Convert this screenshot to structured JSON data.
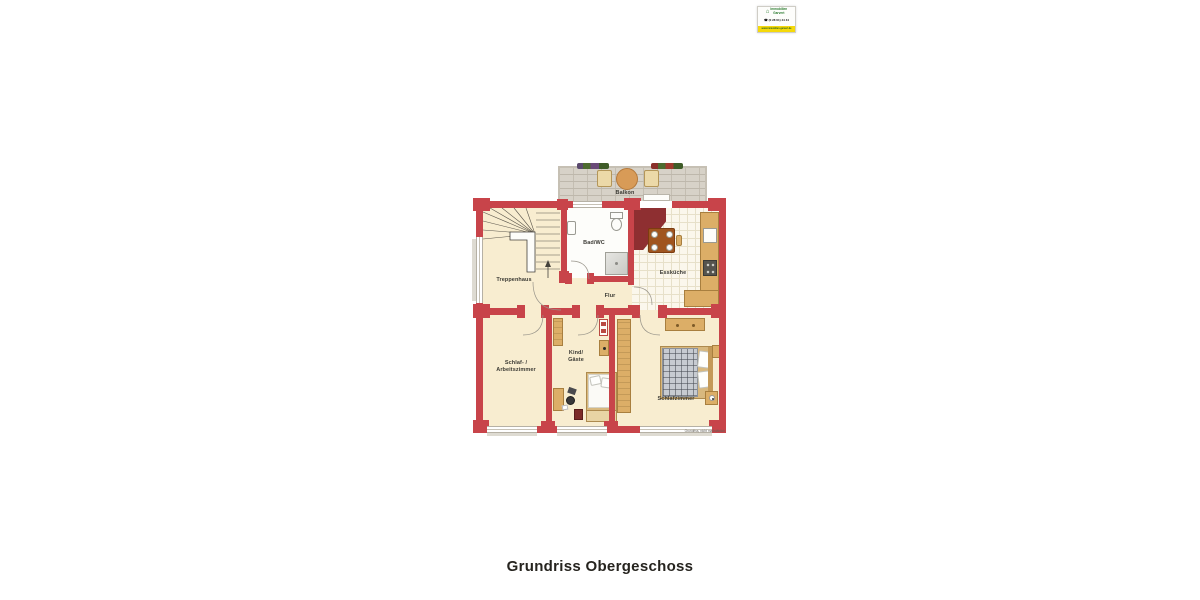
{
  "header_logo": {
    "name_line1": "Immobilien",
    "name_line2": "Garvert",
    "phone": "☎ (0 28 61) 44 44",
    "website": "www.immobilien-garvert.de",
    "house_glyph": "⌂"
  },
  "floorplan": {
    "rooms": {
      "balkon": "Balkon",
      "treppenhaus": "Treppenhaus",
      "bad_wc": "Bad/WC",
      "esskueche": "Essküche",
      "flur": "Flur",
      "schlaf_line1": "Schlaf- /",
      "schlaf_line2": "Arbeitszimmer",
      "kind_line1": "Kind/",
      "kind_line2": "Gäste",
      "schlafzimmer": "Schlafzimmer"
    },
    "disclaimer": "Grundriss, nicht maßstäblich"
  },
  "caption": "Grundriss Obergeschoss",
  "colors": {
    "wall_red": "#c8444a",
    "accent_dark_red": "#8e2f31",
    "floor_cream": "#f8edd0",
    "furniture_tan": "#dcae67",
    "balcony_grey": "#d7d2c8",
    "logo_green": "#2e7d32",
    "logo_yellow": "#f5d90a"
  }
}
